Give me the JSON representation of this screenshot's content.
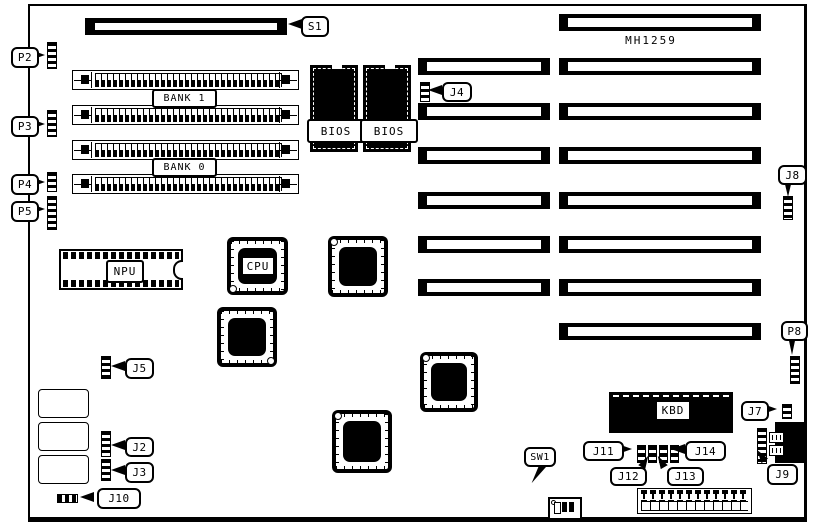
{
  "board": {
    "model": "MH1259",
    "background_color": "#ffffff",
    "line_color": "#000000"
  },
  "callouts": {
    "p2": "P2",
    "p3": "P3",
    "p4": "P4",
    "p5": "P5",
    "s1": "S1",
    "j4": "J4",
    "j5": "J5",
    "j2": "J2",
    "j3": "J3",
    "j10": "J10",
    "j8": "J8",
    "p8": "P8",
    "j7": "J7",
    "j9": "J9",
    "j11": "J11",
    "j12": "J12",
    "j13": "J13",
    "j14": "J14",
    "sw1": "SW1"
  },
  "chips": {
    "npu": "NPU",
    "cpu": "CPU",
    "kbd": "KBD",
    "bios": "BIOS"
  },
  "memory": {
    "bank1": "BANK 1",
    "bank0": "BANK 0"
  }
}
